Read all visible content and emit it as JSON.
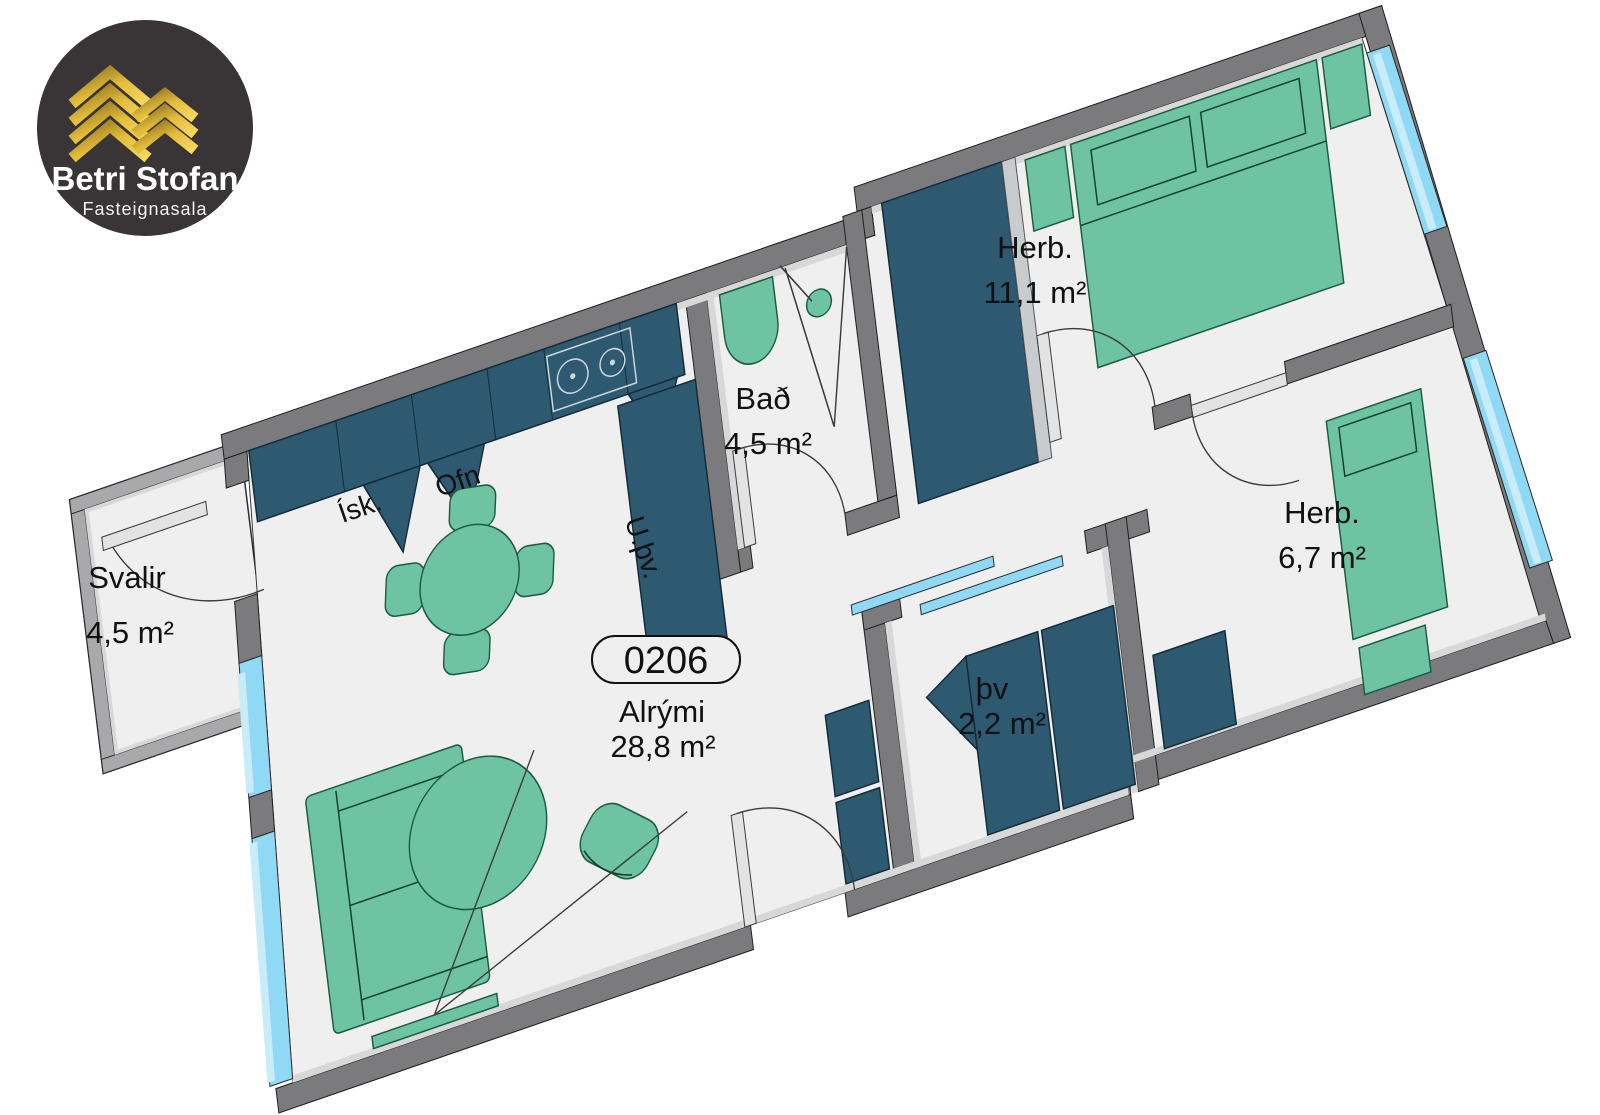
{
  "logo": {
    "title": "Betri Stofan",
    "subtitle": "Fasteignasala",
    "bg_color": "#393536",
    "gold_color": "#e3bd3a"
  },
  "unit_badge": "0206",
  "rooms": {
    "alrymi": {
      "name": "Alrými",
      "area": "28,8 m²"
    },
    "bedroom1": {
      "name": "Herb.",
      "area": "11,1 m²"
    },
    "bedroom2": {
      "name": "Herb.",
      "area": "6,7 m²"
    },
    "bath": {
      "name": "Bað",
      "area": "4,5 m²"
    },
    "balcony": {
      "name": "Svalir",
      "area": "4,5 m²"
    },
    "laundry": {
      "name": "þv",
      "area": "2,2 m²"
    }
  },
  "kitchen": {
    "fridge": "Ísk.",
    "oven": "Ofn"
  },
  "utility_label": "U.þv.",
  "colors": {
    "floor": "#efeff0",
    "wall": "#7b7b7d",
    "wall_light": "#d8d8d9",
    "rail": "#a9a9ab",
    "furniture_dark": "#2d5971",
    "furniture_green": "#6ec3a3",
    "green_stroke": "#1d5c44",
    "window": "#8fd9f5",
    "window_light": "#c9ecfa",
    "outline": "#2a2a2a"
  }
}
